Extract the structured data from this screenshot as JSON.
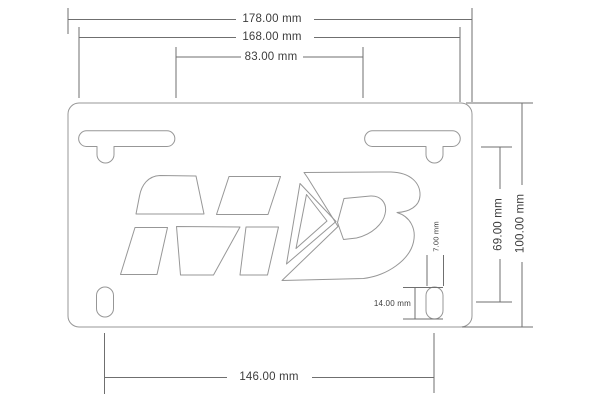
{
  "colors": {
    "line": "#979797",
    "dim": "#6f6f6f",
    "text": "#3d3d3d",
    "background": "#ffffff"
  },
  "drawing": {
    "kind": "dimensioned technical drawing",
    "logo_mark": "MD",
    "unit": "mm",
    "dims": {
      "overall_width": "178.00 mm",
      "slots_outer_width": "168.00 mm",
      "slots_inner_gap": "83.00 mm",
      "overall_height": "100.00 mm",
      "slot_to_hole_height": "69.00 mm",
      "hole_spacing": "146.00 mm",
      "hole_width": "7.00 mm",
      "hole_height": "14.00 mm"
    }
  }
}
